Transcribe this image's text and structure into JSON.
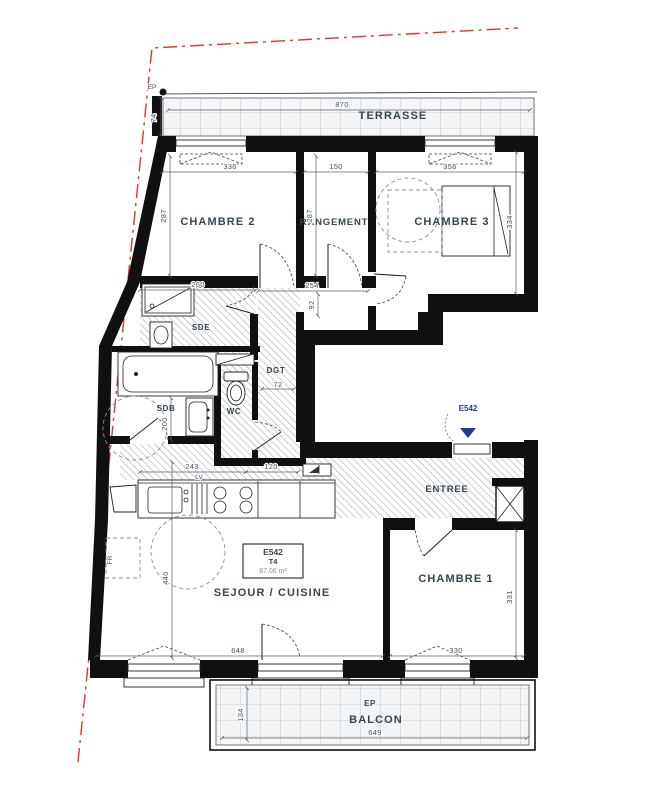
{
  "rooms": {
    "terrasse": "TERRASSE",
    "chambre2": "CHAMBRE 2",
    "rangement": "RANGEMENT",
    "chambre3": "CHAMBRE 3",
    "sde": "SDE",
    "dgt": "DGT",
    "wc": "WC",
    "sdb": "SDB",
    "sejour": "SEJOUR / CUISINE",
    "entree": "ENTREE",
    "chambre1": "CHAMBRE 1",
    "balcon": "BALCON"
  },
  "unit": {
    "code": "E542",
    "type": "T4",
    "area": "87.06 m²"
  },
  "entry": {
    "label": "E542"
  },
  "equipment": {
    "fridge": "FR",
    "dishwasher": "LV",
    "ep_terrasse": "EP",
    "ep_balcon": "EP"
  },
  "dims": {
    "terrasse_w": "870",
    "terrasse_d": "74",
    "chambre2_w": "336",
    "chambre2_h": "287",
    "rangement_w": "150",
    "rangement_h": "287",
    "chambre3_w": "356",
    "chambre3_h": "334",
    "sde_w": "260",
    "hall_l": "254",
    "hall_w": "92",
    "dgt_w": "72",
    "sdb_d": "200",
    "kitchen_l": "440",
    "kitchen_a": "243",
    "kitchen_b": "120",
    "sejour_w": "648",
    "chambre1_w": "330",
    "chambre1_h": "331",
    "balcon_w": "649",
    "balcon_d": "134"
  },
  "colors": {
    "wall": "#101010",
    "boundary": "#e5342e",
    "label": "#36464f",
    "dim": "#44525f",
    "entry_marker": "#223a8f",
    "tile_bg": "#f3f5f7"
  }
}
